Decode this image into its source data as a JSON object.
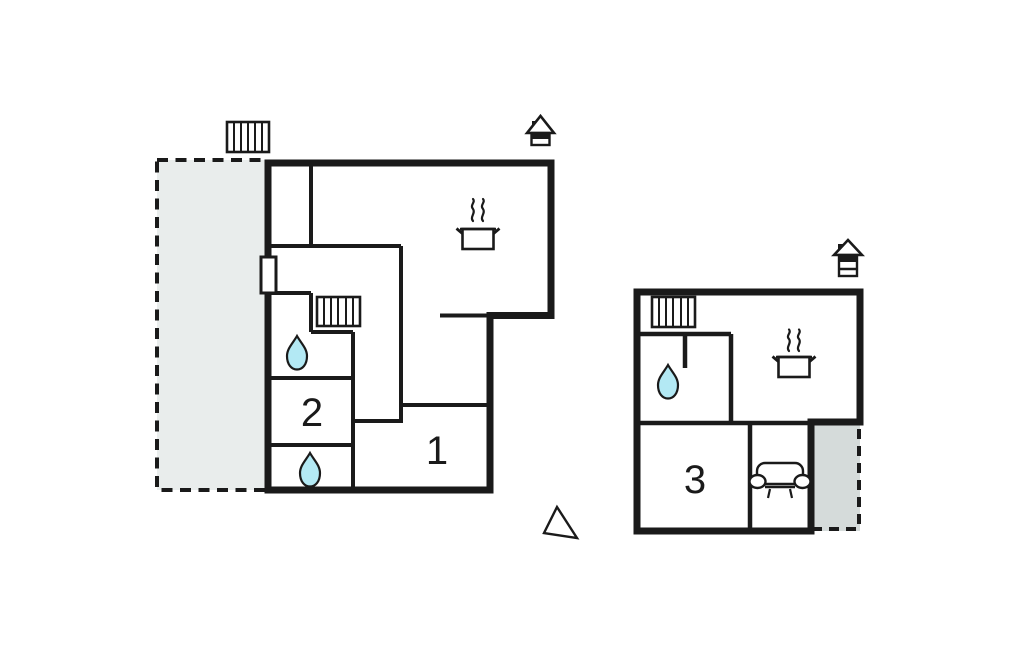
{
  "page": {
    "type": "floor-plan",
    "background": "#ffffff"
  },
  "colors": {
    "wall": "#1a1a1a",
    "terrace_main": "#e9edec",
    "terrace_annex": "#d5dbda",
    "water": "#b3e9f4",
    "text": "#1a1a1a"
  },
  "rooms": {
    "room1": {
      "label": "1"
    },
    "room2": {
      "label": "2"
    },
    "room3": {
      "label": "3"
    }
  },
  "icons": {
    "stairs-icon": "▦",
    "house-level-icon": "⌂",
    "water-drop-icon": "💧",
    "cooking-pot-icon": "♨",
    "sofa-icon": "🛋",
    "north-arrow-icon": "◿",
    "door-icon": "▯"
  }
}
